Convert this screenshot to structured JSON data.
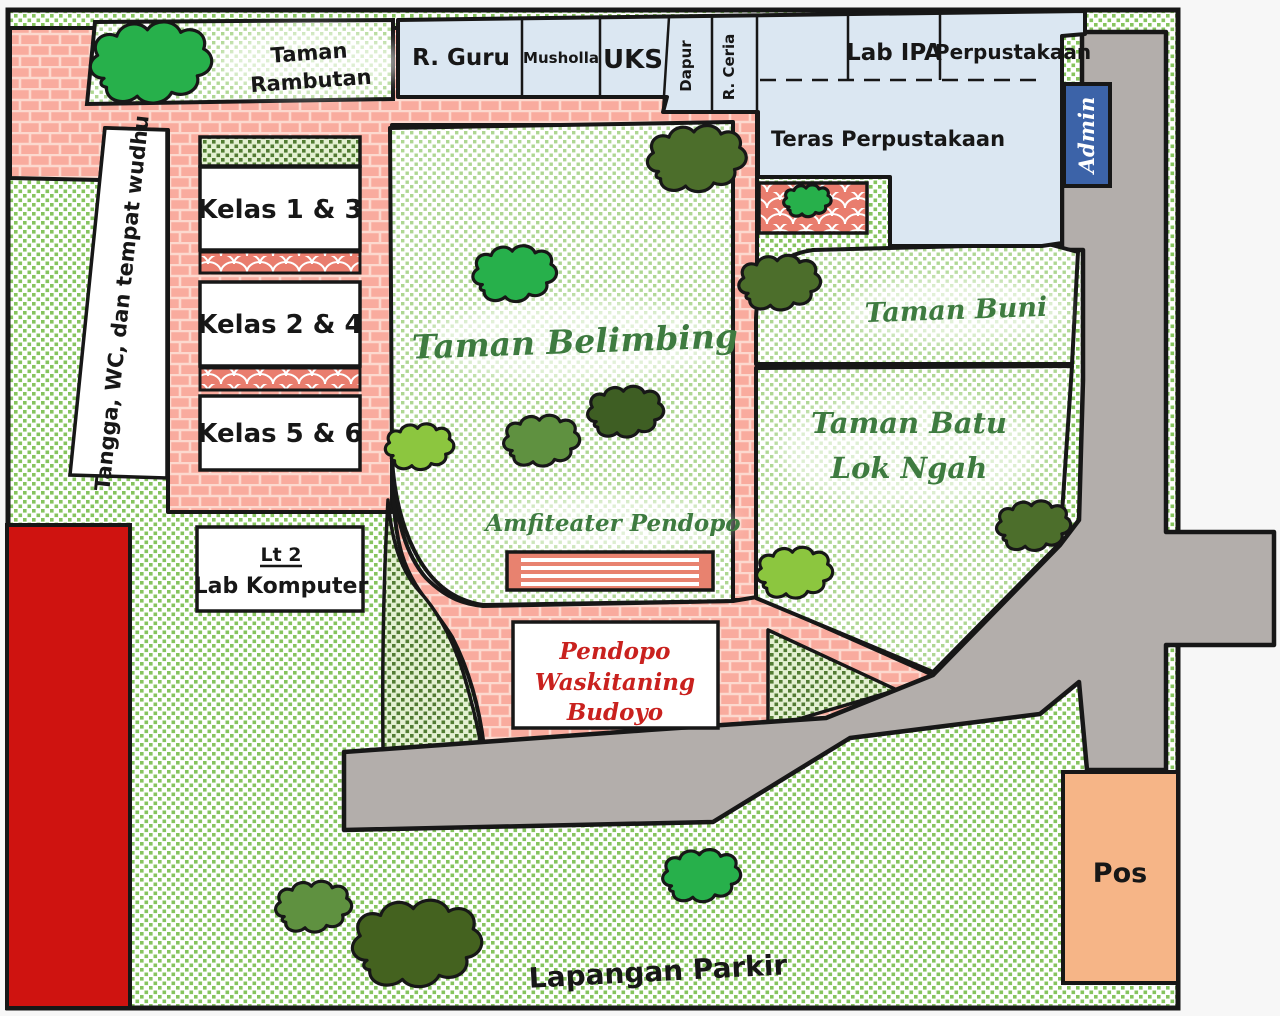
{
  "map": {
    "rooms": {
      "r_guru": "R. Guru",
      "musholla": "Musholla",
      "uks": "UKS",
      "dapur": "Dapur",
      "r_ceria": "R. Ceria",
      "lab_ipa": "Lab IPA",
      "perpustakaan": "Perpustakaan",
      "teras": "Teras Perpustakaan",
      "admin": "Admin",
      "tangga": "Tangga, WC, dan tempat wudhu",
      "lab_komputer_line1": "Lt 2",
      "lab_komputer_line2": "Lab Komputer",
      "pos": "Pos"
    },
    "classrooms": {
      "k13": "Kelas 1 & 3",
      "k24": "Kelas 2 & 4",
      "k56": "Kelas 5 & 6"
    },
    "gardens": {
      "rambutan_line1": "Taman",
      "rambutan_line2": "Rambutan",
      "belimbing": "Taman Belimbing",
      "amfiteater": "Amfiteater Pendopo",
      "buni": "Taman Buni",
      "batu_line1": "Taman Batu",
      "batu_line2": "Lok Ngah",
      "pendopo_line1": "Pendopo",
      "pendopo_line2": "Waskitaning",
      "pendopo_line3": "Budoyo"
    },
    "areas": {
      "lapangan": "Lapangan Parkir"
    },
    "colors": {
      "brick_path": "#f9ab9e",
      "brick_mortar": "#fcd9cf",
      "scallop_red": "#e97d6e",
      "road_gray": "#b3aeab",
      "building_blue": "#dbe7f2",
      "admin_blue": "#3c63a8",
      "pos_orange": "#f6b587",
      "red_building": "#cf1310",
      "bg_dot_green": "#86c45e",
      "garden_dot_green": "#aed792",
      "dark_dot_green": "#527d33",
      "label_green": "#3e7b40",
      "label_red": "#c9211e",
      "tree_bright": "#27b04b",
      "tree_dark": "#4c6e2b",
      "tree_darkest": "#44621f",
      "tree_medium": "#5f9140",
      "tree_light": "#8cc63f",
      "outline_black": "#171717"
    }
  }
}
